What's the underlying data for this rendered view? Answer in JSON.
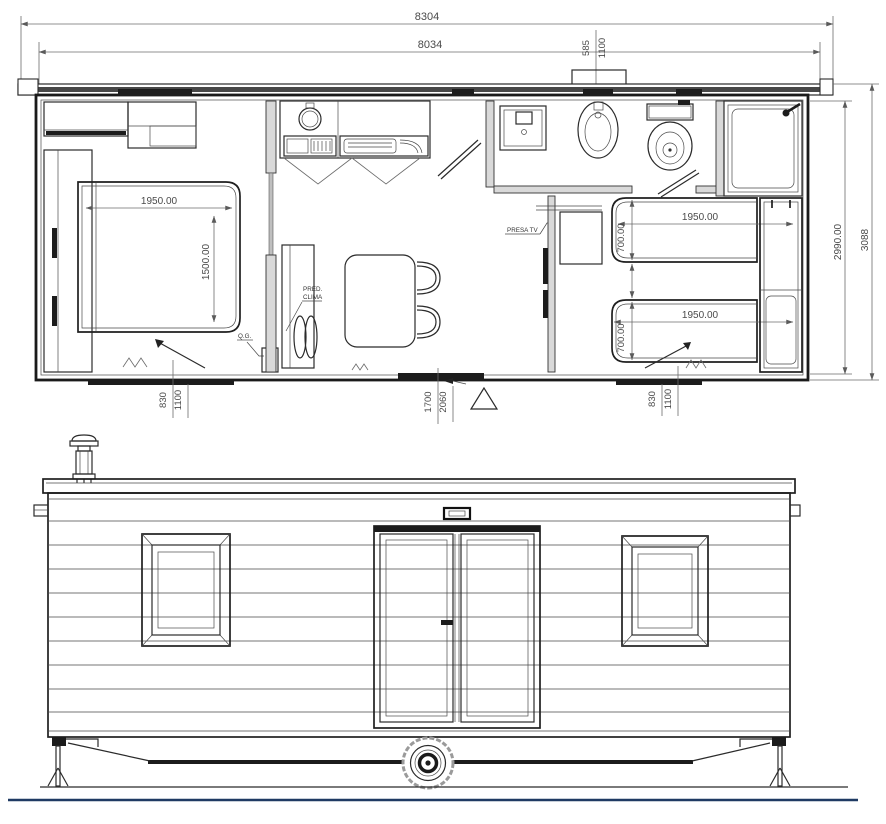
{
  "colors": {
    "accent": "#1f3a63",
    "line": "#2b2b2b",
    "dim_text": "#4a4a4a"
  },
  "floor_plan": {
    "dims": {
      "overall_length": "8304",
      "body_length": "8034",
      "roof_vent_a": "585",
      "roof_vent_b": "1100",
      "master_bed_length": "1950.00",
      "master_bed_width": "1500.00",
      "twin_bed_top_length": "1950.00",
      "twin_bed_top_width": "700.00",
      "twin_bed_bottom_length": "1950.00",
      "twin_bed_bottom_width": "700.00",
      "body_width": "2990.00",
      "overall_width": "3088",
      "door_left_a": "830",
      "door_left_b": "1100",
      "entrance_a": "1700",
      "entrance_b": "2060",
      "door_right_a": "830",
      "door_right_b": "1100"
    },
    "labels": {
      "clima_line1": "PRED.",
      "clima_line2": "CLIMA",
      "qg": "Q.G.",
      "presa_tv": "PRESA TV"
    }
  }
}
